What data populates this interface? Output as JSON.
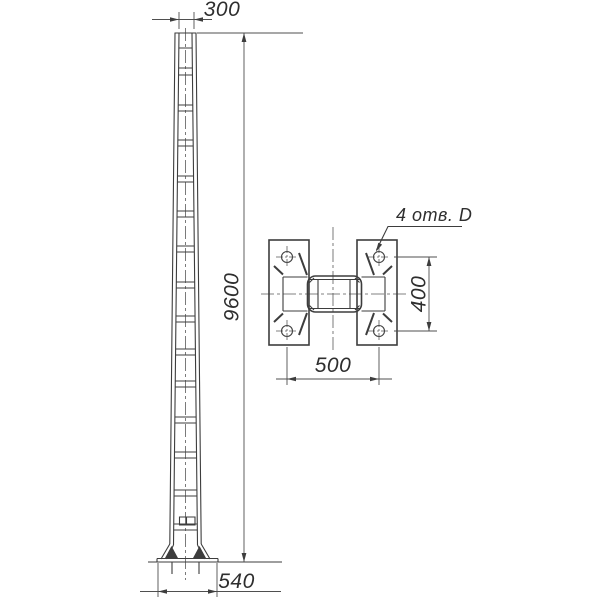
{
  "labels": {
    "front_top_width": "300",
    "front_height": "9600",
    "front_base_width": "540",
    "plan_bolt_span_width": "500",
    "plan_bolt_span_height": "400",
    "plan_holes_note": "4 отв. D"
  },
  "colors": {
    "line": "#3d3d3d",
    "dimension_line": "#4f4f4f",
    "centerline": "#5a5a5a",
    "text": "#2e2e2e",
    "background": "#ffffff"
  }
}
